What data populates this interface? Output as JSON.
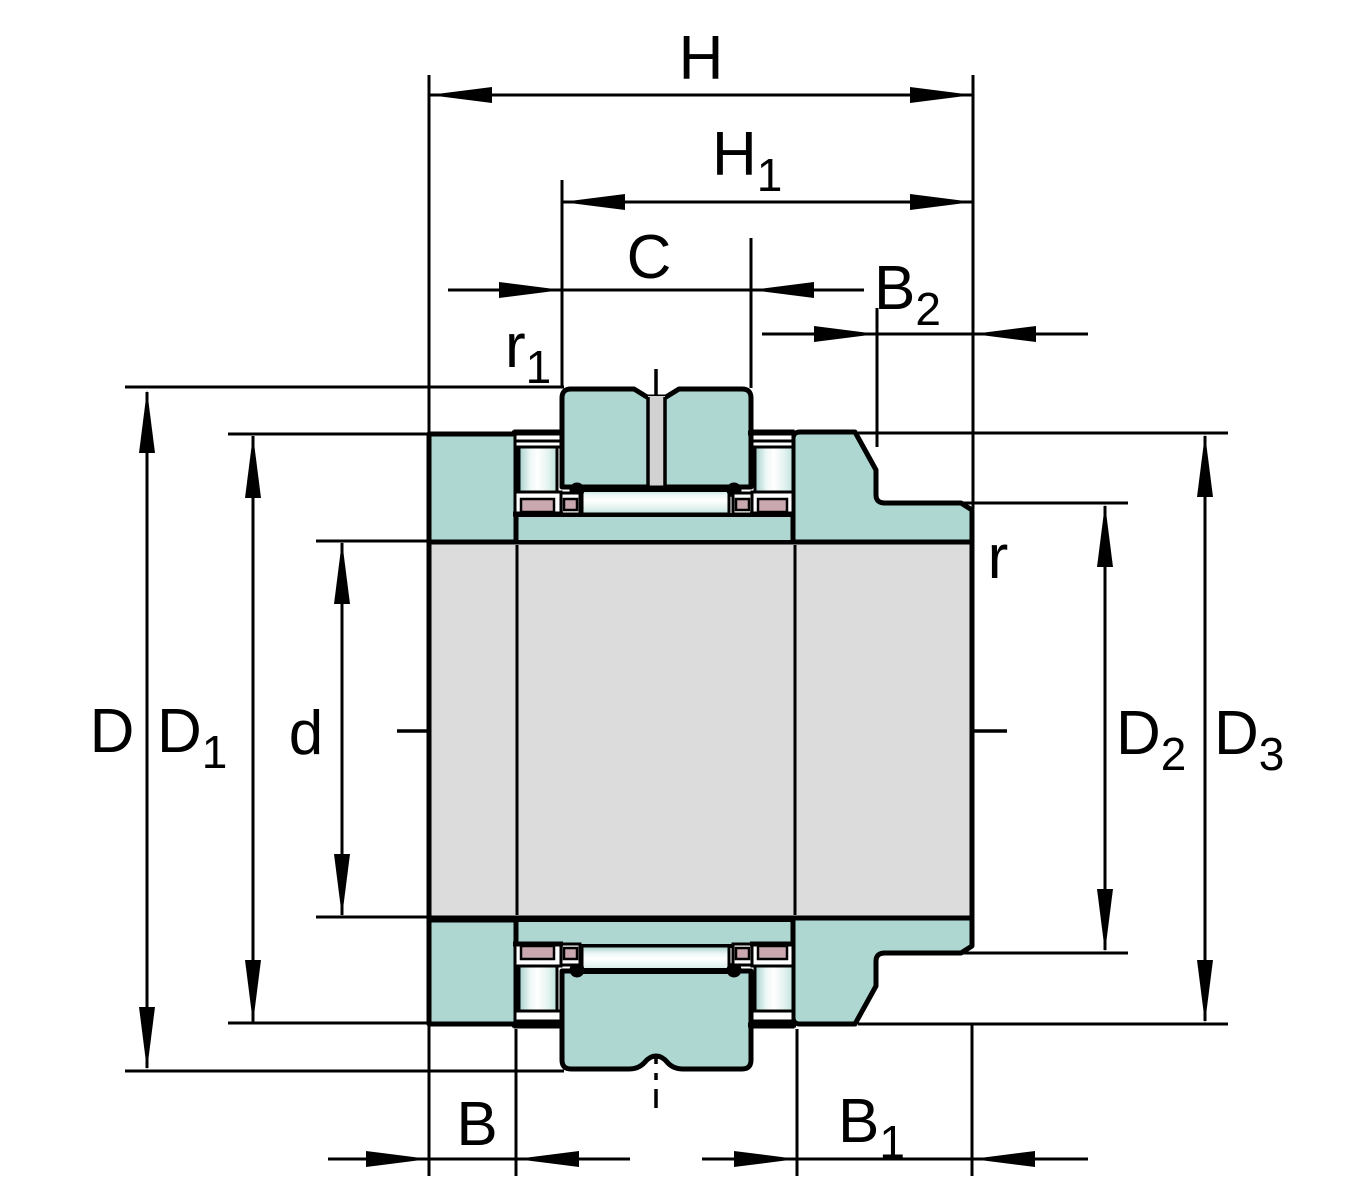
{
  "diagram": {
    "description": "Needle roller / axial cylindrical roller bearing cross-section with dimension lines",
    "colors": {
      "teal": "#aed7d2",
      "shaft_gray": "#dcdcdc",
      "slot_gray": "#d2d2d2",
      "cage_pink": "#c9a9af",
      "line_black": "#000000",
      "background": "#ffffff"
    },
    "labels": {
      "H": {
        "main": "H",
        "sub": ""
      },
      "H1": {
        "main": "H",
        "sub": "1"
      },
      "C": {
        "main": "C",
        "sub": ""
      },
      "B2": {
        "main": "B",
        "sub": "2"
      },
      "r1": {
        "main": "r",
        "sub": "1"
      },
      "r": {
        "main": "r",
        "sub": ""
      },
      "D": {
        "main": "D",
        "sub": ""
      },
      "D1": {
        "main": "D",
        "sub": "1"
      },
      "d": {
        "main": "d",
        "sub": ""
      },
      "D2": {
        "main": "D",
        "sub": "2"
      },
      "D3": {
        "main": "D",
        "sub": "3"
      },
      "B": {
        "main": "B",
        "sub": ""
      },
      "B1": {
        "main": "B",
        "sub": "1"
      }
    }
  }
}
